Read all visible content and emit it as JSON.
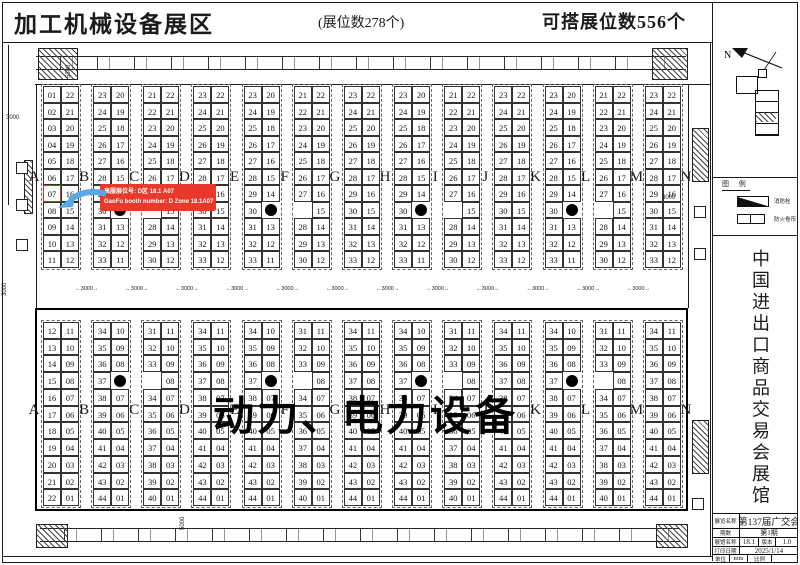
{
  "header": {
    "title": "加工机械设备展区",
    "booth_count": "(展位数278个)",
    "buildable_count": "可搭展位数556个"
  },
  "callout": {
    "line1": "高服展位号: D区 18.1 A07",
    "line2": "GaoFu booth number: D Zone 18.1A07",
    "highlight_booth": "07"
  },
  "overlay_label": {
    "part1": "动力、",
    "part2": "电力设备"
  },
  "aisle_letters": [
    "A",
    "B",
    "C",
    "D",
    "E",
    "F",
    "G",
    "H",
    "I",
    "J",
    "K",
    "L",
    "M",
    "N"
  ],
  "dimensions": {
    "aisle_width": "3000",
    "left_top": "5300",
    "left_small": "3000",
    "left_bottom_v": "3000",
    "bottom_center_v": "5000",
    "right_small": "3000"
  },
  "top_strips": [
    {
      "aisle": "A",
      "left": [
        "01",
        "02",
        "03",
        "04",
        "05",
        "06",
        "07",
        "08",
        "09",
        "10",
        "11"
      ],
      "right": [
        "22",
        "21",
        "20",
        "19",
        "18",
        "17",
        "16",
        "15",
        "14",
        "13",
        "12"
      ]
    },
    {
      "aisle": "B",
      "left": [
        "23",
        "24",
        "25",
        "26",
        "27",
        "28",
        "29",
        "30",
        "31",
        "32",
        "33"
      ],
      "right": [
        "20",
        "19",
        "18",
        "17",
        "16",
        "15",
        "14",
        "DOT",
        "13",
        "12",
        "11"
      ]
    },
    {
      "aisle": "C",
      "left": [
        "21",
        "22",
        "23",
        "24",
        "25",
        "26",
        "27",
        "",
        "28",
        "29",
        "30"
      ],
      "right": [
        "22",
        "21",
        "20",
        "19",
        "18",
        "17",
        "16",
        "15",
        "14",
        "13",
        "12"
      ]
    },
    {
      "aisle": "D",
      "left": [
        "23",
        "24",
        "25",
        "26",
        "27",
        "28",
        "29",
        "30",
        "31",
        "32",
        "33"
      ],
      "right": [
        "22",
        "21",
        "20",
        "19",
        "18",
        "17",
        "16",
        "15",
        "14",
        "13",
        "12"
      ]
    },
    {
      "aisle": "E",
      "left": [
        "23",
        "24",
        "25",
        "26",
        "27",
        "28",
        "29",
        "30",
        "31",
        "32",
        "33"
      ],
      "right": [
        "20",
        "19",
        "18",
        "17",
        "16",
        "15",
        "14",
        "DOT",
        "13",
        "12",
        "11"
      ]
    },
    {
      "aisle": "F",
      "left": [
        "21",
        "22",
        "23",
        "24",
        "25",
        "26",
        "27",
        "",
        "28",
        "29",
        "30"
      ],
      "right": [
        "22",
        "21",
        "20",
        "19",
        "18",
        "17",
        "16",
        "15",
        "14",
        "13",
        "12"
      ]
    },
    {
      "aisle": "G",
      "left": [
        "23",
        "24",
        "25",
        "26",
        "27",
        "28",
        "29",
        "30",
        "31",
        "32",
        "33"
      ],
      "right": [
        "22",
        "21",
        "20",
        "19",
        "18",
        "17",
        "16",
        "15",
        "14",
        "13",
        "12"
      ]
    },
    {
      "aisle": "H",
      "left": [
        "23",
        "24",
        "25",
        "26",
        "27",
        "28",
        "29",
        "30",
        "31",
        "32",
        "33"
      ],
      "right": [
        "20",
        "19",
        "18",
        "17",
        "16",
        "15",
        "14",
        "DOT",
        "13",
        "12",
        "11"
      ]
    },
    {
      "aisle": "I",
      "left": [
        "21",
        "22",
        "23",
        "24",
        "25",
        "26",
        "27",
        "",
        "28",
        "29",
        "30"
      ],
      "right": [
        "22",
        "21",
        "20",
        "19",
        "18",
        "17",
        "16",
        "15",
        "14",
        "13",
        "12"
      ]
    },
    {
      "aisle": "J",
      "left": [
        "23",
        "24",
        "25",
        "26",
        "27",
        "28",
        "29",
        "30",
        "31",
        "32",
        "33"
      ],
      "right": [
        "22",
        "21",
        "20",
        "19",
        "18",
        "17",
        "16",
        "15",
        "14",
        "13",
        "12"
      ]
    },
    {
      "aisle": "K",
      "left": [
        "23",
        "24",
        "25",
        "26",
        "27",
        "28",
        "29",
        "30",
        "31",
        "32",
        "33"
      ],
      "right": [
        "20",
        "19",
        "18",
        "17",
        "16",
        "15",
        "14",
        "DOT",
        "13",
        "12",
        "11"
      ]
    },
    {
      "aisle": "L",
      "left": [
        "21",
        "22",
        "23",
        "24",
        "25",
        "26",
        "27",
        "",
        "28",
        "29",
        "30"
      ],
      "right": [
        "22",
        "21",
        "20",
        "19",
        "18",
        "17",
        "16",
        "15",
        "14",
        "13",
        "12"
      ]
    },
    {
      "aisle": "M",
      "left": [
        "23",
        "24",
        "25",
        "26",
        "27",
        "28",
        "29",
        "30",
        "31",
        "32",
        "33"
      ],
      "right": [
        "22",
        "21",
        "20",
        "19",
        "18",
        "17",
        "16",
        "15",
        "14",
        "13",
        "12"
      ]
    }
  ],
  "bottom_strips": [
    {
      "aisle": "A",
      "left": [
        "12",
        "13",
        "14",
        "15",
        "16",
        "17",
        "18",
        "19",
        "20",
        "21",
        "22"
      ],
      "right": [
        "11",
        "10",
        "09",
        "08",
        "07",
        "06",
        "05",
        "04",
        "03",
        "02",
        "01"
      ]
    },
    {
      "aisle": "B",
      "left": [
        "34",
        "35",
        "36",
        "37",
        "38",
        "39",
        "40",
        "41",
        "42",
        "43",
        "44"
      ],
      "right": [
        "10",
        "09",
        "08",
        "DOT",
        "07",
        "06",
        "05",
        "04",
        "03",
        "02",
        "01"
      ]
    },
    {
      "aisle": "C",
      "left": [
        "31",
        "32",
        "33",
        "",
        "34",
        "35",
        "36",
        "37",
        "38",
        "39",
        "40"
      ],
      "right": [
        "11",
        "10",
        "09",
        "08",
        "07",
        "06",
        "05",
        "04",
        "03",
        "02",
        "01"
      ]
    },
    {
      "aisle": "D",
      "left": [
        "34",
        "35",
        "36",
        "37",
        "38",
        "39",
        "40",
        "41",
        "42",
        "43",
        "44"
      ],
      "right": [
        "11",
        "10",
        "09",
        "08",
        "07",
        "06",
        "05",
        "04",
        "03",
        "02",
        "01"
      ]
    },
    {
      "aisle": "E",
      "left": [
        "34",
        "35",
        "36",
        "37",
        "38",
        "39",
        "40",
        "41",
        "42",
        "43",
        "44"
      ],
      "right": [
        "10",
        "09",
        "08",
        "DOT",
        "07",
        "06",
        "05",
        "04",
        "03",
        "02",
        "01"
      ]
    },
    {
      "aisle": "F",
      "left": [
        "31",
        "32",
        "33",
        "",
        "34",
        "35",
        "36",
        "37",
        "38",
        "39",
        "40"
      ],
      "right": [
        "11",
        "10",
        "09",
        "08",
        "07",
        "06",
        "05",
        "04",
        "03",
        "02",
        "01"
      ]
    },
    {
      "aisle": "G",
      "left": [
        "34",
        "35",
        "36",
        "37",
        "38",
        "39",
        "40",
        "41",
        "42",
        "43",
        "44"
      ],
      "right": [
        "11",
        "10",
        "09",
        "08",
        "07",
        "06",
        "05",
        "04",
        "03",
        "02",
        "01"
      ]
    },
    {
      "aisle": "H",
      "left": [
        "34",
        "35",
        "36",
        "37",
        "38",
        "39",
        "40",
        "41",
        "42",
        "43",
        "44"
      ],
      "right": [
        "10",
        "09",
        "08",
        "DOT",
        "07",
        "06",
        "05",
        "04",
        "03",
        "02",
        "01"
      ]
    },
    {
      "aisle": "I",
      "left": [
        "31",
        "32",
        "33",
        "",
        "34",
        "35",
        "36",
        "37",
        "38",
        "39",
        "40"
      ],
      "right": [
        "11",
        "10",
        "09",
        "08",
        "07",
        "06",
        "05",
        "04",
        "03",
        "02",
        "01"
      ]
    },
    {
      "aisle": "J",
      "left": [
        "34",
        "35",
        "36",
        "37",
        "38",
        "39",
        "40",
        "41",
        "42",
        "43",
        "44"
      ],
      "right": [
        "11",
        "10",
        "09",
        "08",
        "07",
        "06",
        "05",
        "04",
        "03",
        "02",
        "01"
      ]
    },
    {
      "aisle": "K",
      "left": [
        "34",
        "35",
        "36",
        "37",
        "38",
        "39",
        "40",
        "41",
        "42",
        "43",
        "44"
      ],
      "right": [
        "10",
        "09",
        "08",
        "DOT",
        "07",
        "06",
        "05",
        "04",
        "03",
        "02",
        "01"
      ]
    },
    {
      "aisle": "L",
      "left": [
        "31",
        "32",
        "33",
        "",
        "34",
        "35",
        "36",
        "37",
        "38",
        "39",
        "40"
      ],
      "right": [
        "11",
        "10",
        "09",
        "08",
        "07",
        "06",
        "05",
        "04",
        "03",
        "02",
        "01"
      ]
    },
    {
      "aisle": "M",
      "left": [
        "34",
        "35",
        "36",
        "37",
        "38",
        "39",
        "40",
        "41",
        "42",
        "43",
        "44"
      ],
      "right": [
        "11",
        "10",
        "09",
        "08",
        "07",
        "06",
        "05",
        "04",
        "03",
        "02",
        "01"
      ]
    }
  ],
  "sidebar": {
    "north_label": "N",
    "legend": {
      "title": "图 例",
      "item1": "消防栓",
      "item2": "防火卷帘"
    },
    "facility_name": "中国进出口商品交易会展馆",
    "title_block": {
      "r1_label": "展览名称",
      "r1_value": "第137届广交会",
      "r2_label": "期数",
      "r2_value": "第1期",
      "r3_label": "展馆名称",
      "r3_value": "18.1",
      "r3_label2": "版本",
      "r3_value2": "1.0",
      "r4_label": "打印日期",
      "r4_value": "2025/1/14",
      "r5_label": "单位",
      "r5_value": "mm",
      "r5_label2": "比例",
      "r5_value2": ""
    }
  },
  "colors": {
    "highlight_red": "#e8392b",
    "arrow_blue": "#58a7e6",
    "line_black": "#1b1b1b"
  }
}
